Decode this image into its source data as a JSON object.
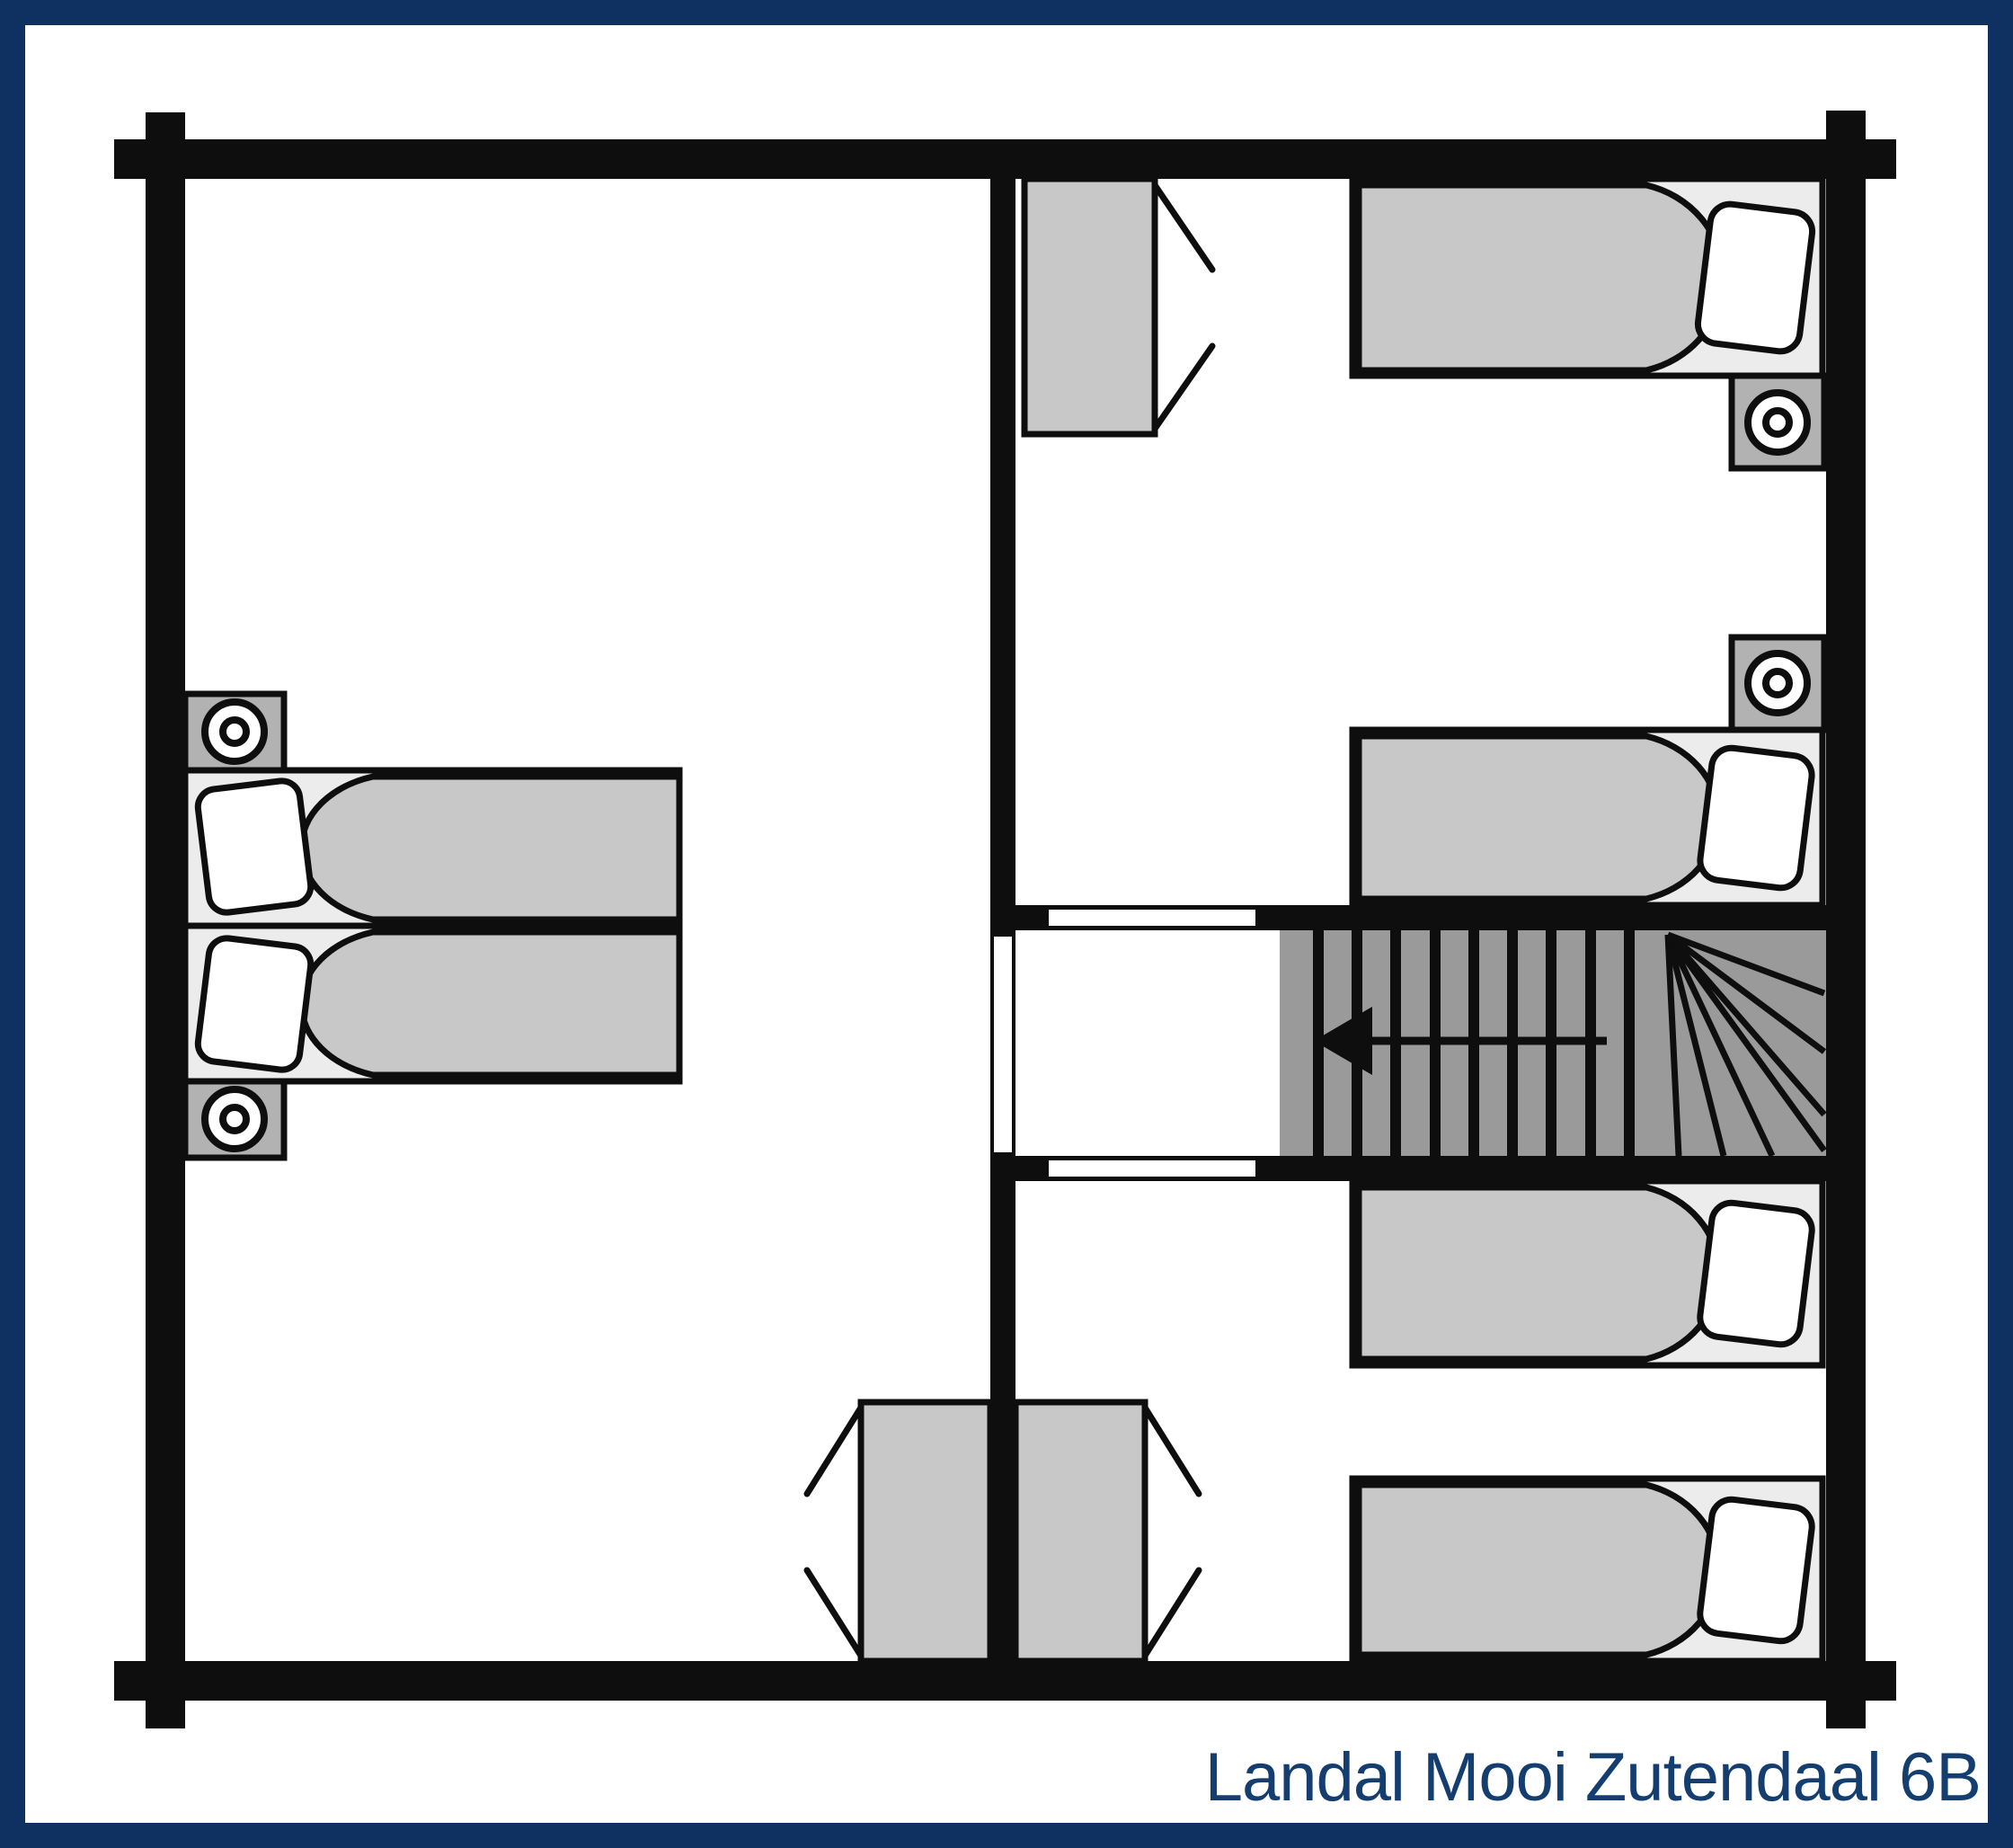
{
  "title": {
    "label": "Landal Mooi Zutendaal 6B"
  },
  "colors": {
    "border_navy": "#0e3161",
    "title_navy": "#153e70",
    "wall_ink": "#0e0e0e",
    "stairs_gray": "#9a9a9a",
    "duvet_gray": "#c8c8c8",
    "wardrobe_gray": "#c8c8c8",
    "nightstand_gray": "#b2b2b2",
    "mattress_gray": "#ececec",
    "background": "#ffffff"
  },
  "floor_plan": {
    "type": "upper-floor bedroom plan",
    "rooms": [
      {
        "name": "left bedroom",
        "furniture": [
          "double bed (two singles)",
          "nightstand with lamp (top)",
          "nightstand with lamp (bottom)",
          "wardrobe (doors open left)"
        ]
      },
      {
        "name": "top-right bedroom",
        "furniture": [
          "wardrobe (doors open right)",
          "single bed (pillow at right wall)",
          "nightstand with lamp below bed",
          "nightstand with lamp above second bed",
          "single bed above stairs"
        ]
      },
      {
        "name": "bottom-right bedroom",
        "furniture": [
          "single bed (upper)",
          "single bed (lower)",
          "wardrobe (doors open right)"
        ]
      },
      {
        "name": "landing",
        "furniture": [
          "staircase"
        ]
      }
    ],
    "counts": {
      "beds": 6,
      "pillows": 6,
      "wardrobes": 3,
      "nightstands_with_lamps": 4,
      "door_openings": 3
    },
    "stairs": {
      "straight_treads": 9,
      "winder_rays": 7,
      "arrow_direction": "left"
    }
  }
}
